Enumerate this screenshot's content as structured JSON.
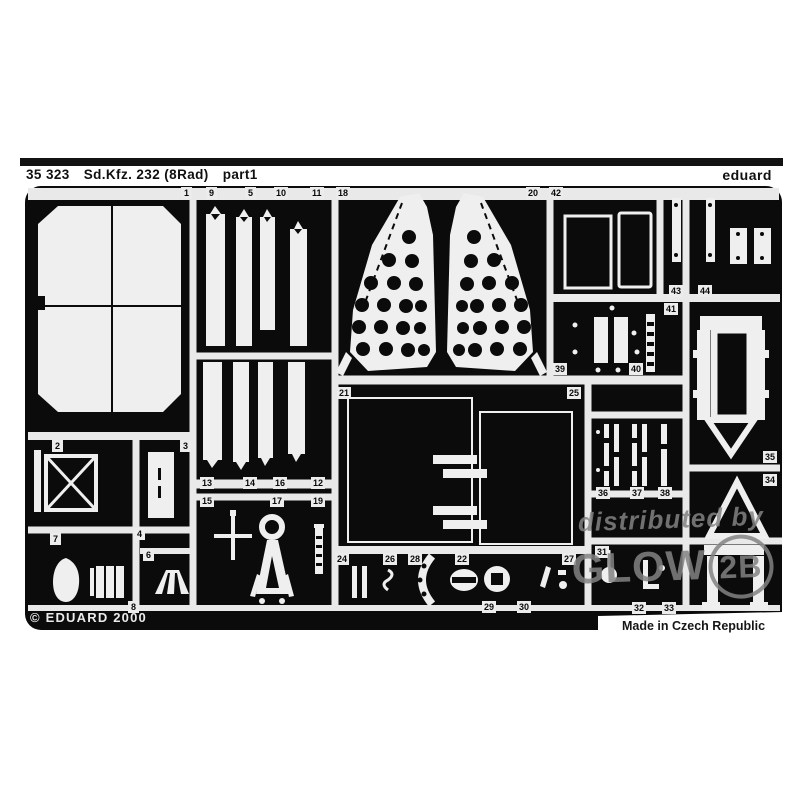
{
  "header": {
    "catalog_number": "35 323",
    "kit_name": "Sd.Kfz. 232 (8Rad)",
    "sheet": "part1",
    "brand": "eduard"
  },
  "footer": {
    "copyright": "© EDUARD 2000",
    "made_in": "Made in Czech Republic"
  },
  "watermark": {
    "prefix": "distributed by",
    "brand_left": "GLOW",
    "brand_right": "2B"
  },
  "colors": {
    "fret_black": "#0b0b0b",
    "part_white": "#efefef",
    "photo_white": "#ffffff",
    "watermark_gray": "#828282"
  },
  "part_labels": [
    {
      "n": "1",
      "x": 181,
      "y": 187
    },
    {
      "n": "9",
      "x": 206,
      "y": 187
    },
    {
      "n": "5",
      "x": 245,
      "y": 187
    },
    {
      "n": "10",
      "x": 274,
      "y": 187
    },
    {
      "n": "11",
      "x": 310,
      "y": 187
    },
    {
      "n": "18",
      "x": 336,
      "y": 187
    },
    {
      "n": "20",
      "x": 526,
      "y": 187
    },
    {
      "n": "42",
      "x": 549,
      "y": 187
    },
    {
      "n": "43",
      "x": 669,
      "y": 285
    },
    {
      "n": "44",
      "x": 698,
      "y": 285
    },
    {
      "n": "41",
      "x": 664,
      "y": 303
    },
    {
      "n": "39",
      "x": 553,
      "y": 363
    },
    {
      "n": "40",
      "x": 629,
      "y": 363
    },
    {
      "n": "35",
      "x": 763,
      "y": 451
    },
    {
      "n": "34",
      "x": 763,
      "y": 474
    },
    {
      "n": "21",
      "x": 337,
      "y": 387
    },
    {
      "n": "25",
      "x": 567,
      "y": 387
    },
    {
      "n": "13",
      "x": 200,
      "y": 477
    },
    {
      "n": "14",
      "x": 243,
      "y": 477
    },
    {
      "n": "16",
      "x": 273,
      "y": 477
    },
    {
      "n": "12",
      "x": 311,
      "y": 477
    },
    {
      "n": "15",
      "x": 200,
      "y": 495
    },
    {
      "n": "17",
      "x": 270,
      "y": 495
    },
    {
      "n": "19",
      "x": 311,
      "y": 495
    },
    {
      "n": "2",
      "x": 52,
      "y": 440
    },
    {
      "n": "3",
      "x": 180,
      "y": 440
    },
    {
      "n": "4",
      "x": 134,
      "y": 528
    },
    {
      "n": "6",
      "x": 143,
      "y": 549
    },
    {
      "n": "7",
      "x": 50,
      "y": 533
    },
    {
      "n": "8",
      "x": 128,
      "y": 601
    },
    {
      "n": "36",
      "x": 596,
      "y": 487
    },
    {
      "n": "37",
      "x": 630,
      "y": 487
    },
    {
      "n": "38",
      "x": 658,
      "y": 487
    },
    {
      "n": "24",
      "x": 335,
      "y": 553
    },
    {
      "n": "26",
      "x": 383,
      "y": 553
    },
    {
      "n": "28",
      "x": 408,
      "y": 553
    },
    {
      "n": "22",
      "x": 455,
      "y": 553
    },
    {
      "n": "27",
      "x": 562,
      "y": 553
    },
    {
      "n": "29",
      "x": 482,
      "y": 601
    },
    {
      "n": "30",
      "x": 517,
      "y": 601
    },
    {
      "n": "31",
      "x": 595,
      "y": 546
    },
    {
      "n": "32",
      "x": 632,
      "y": 602
    },
    {
      "n": "33",
      "x": 662,
      "y": 602
    }
  ]
}
